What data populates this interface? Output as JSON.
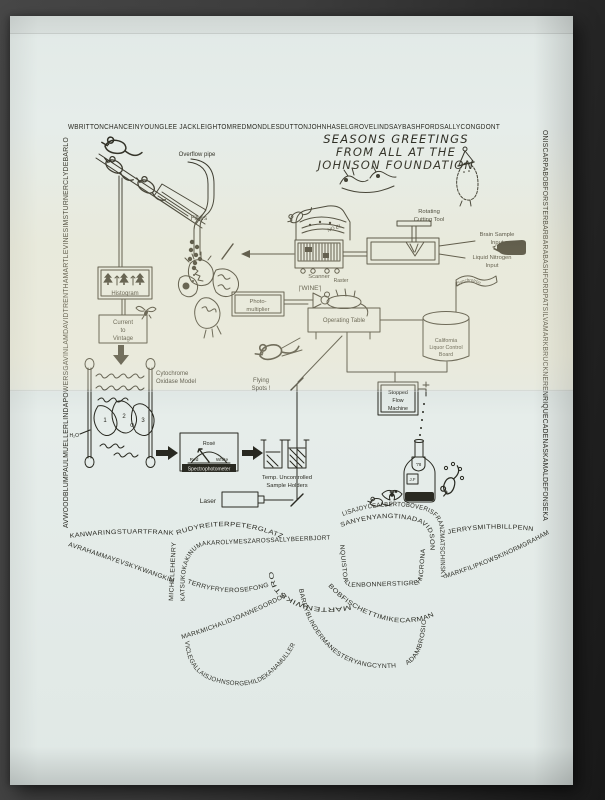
{
  "title": {
    "line1": "SEASONS GREETINGS",
    "line2": "FROM ALL AT THE",
    "line3": "JOHNSON FOUNDATION"
  },
  "border": {
    "top": "WBRITTONCHANCEINYOUNGLEE JACKLEIGHTOMREDMONDLESDUTTONJOHNHASELGROVELINDSAYBASHFORDSALLYCONGDONT",
    "left": "AVWOODBLUMPAULMUELLERLINDAPOWERSGAVINLAMDAVIDTRENTHAMARTLEVINESIMSTURNERCLYDEBARLO",
    "right": "ONISCARPABOBFORSTERBARBARABASHFORDPATSILVAMARKBRUCKNERENRIQUECADENASKAMALDEFONSEKA"
  },
  "labels": {
    "overflow_pipe": "Overflow pipe",
    "filters": "Filters",
    "histogram": "Histogram",
    "current1": "Current",
    "current2": "to",
    "current3": "Vintage",
    "cyto1": "Cytochrome",
    "cyto2": "Oxidase Model",
    "h2o": "H₂O",
    "o2": "O₂",
    "n1": "1",
    "n2": "2",
    "n3": "3",
    "noel": "NO EL",
    "scanner": "Scanner",
    "rot1": "Rotating",
    "rot2": "Cutting Tool",
    "brain1": "Brain Sample",
    "brain2": "Input",
    "liq1": "Liquid Nitrogen",
    "liq2": "Input",
    "photo1": "Photo-",
    "photo2": "multiplier",
    "wine": "|'WINE'|",
    "raster": "Raster",
    "optable": "Operating  Table",
    "sync": "Synchrotron",
    "cal1": "California",
    "cal2": "Liquor Control",
    "cal3": "Board",
    "fly1": "Flying",
    "fly2": "Spots !",
    "stop1": "Stopped",
    "stop2": "Flow",
    "stop3": "Machine",
    "rose": "Rosé",
    "red": "Red",
    "white": "White",
    "spectro": "Spectrophotometer",
    "temp1": "Temp. Uncontrolled",
    "temp2": "Sample  Holders",
    "laser": "Laser",
    "year": "'78",
    "jf": "J.F"
  },
  "bow": {
    "runs": [
      {
        "id": "left-upper",
        "text": "KANWARINGSTUARTFRANK"
      },
      {
        "id": "left-lower",
        "text": "AVRAHAMMAYEVSKYKWANGKIM"
      },
      {
        "id": "knot-left-vertical",
        "text": "MICHELEHENRY"
      },
      {
        "id": "left-loop-inner",
        "text": "KATSUKOKAKINUMAKAROLYMESZAROSSALLYBEERBJORT"
      },
      {
        "id": "left-loop-top",
        "text": "RUDYREITERPETERGLATZ"
      },
      {
        "id": "left-loop-bottom",
        "text": "TERRYFRYEROSEFONG"
      },
      {
        "id": "knot-flip",
        "text": "MARTENWIKSTROM"
      },
      {
        "id": "right-loop-inner-bottom",
        "text": "NQUISTOALLENBONNERSTIGREHNCRONA"
      },
      {
        "id": "right-loop-outer",
        "text": "LISAJOYCEALBERTOBOVERISFRANZMATSCHINSKY"
      },
      {
        "id": "right-loop-inner-top",
        "text": "SANYENYANGTINADAVIDSON"
      },
      {
        "id": "right-upper",
        "text": "JERRYSMITHBILLPENN"
      },
      {
        "id": "right-lower",
        "text": "MARKFILIPKOWSKINORMGRAHAM"
      },
      {
        "id": "right-loop-under",
        "text": "BOBFISCHETTIMIKECARMAN"
      },
      {
        "id": "right-tail-down",
        "text": "BARRYBLINDERMANESTERYANGCYNTH"
      },
      {
        "id": "right-tail-up",
        "text": "ADAMBROSIO"
      },
      {
        "id": "left-tail-upper",
        "text": "MARKMICHALIDJOANNEGORDON"
      },
      {
        "id": "left-tail-lower",
        "text": "VICLEGALLAISJOHNSORGEHILDEKANAMULLER"
      }
    ]
  }
}
